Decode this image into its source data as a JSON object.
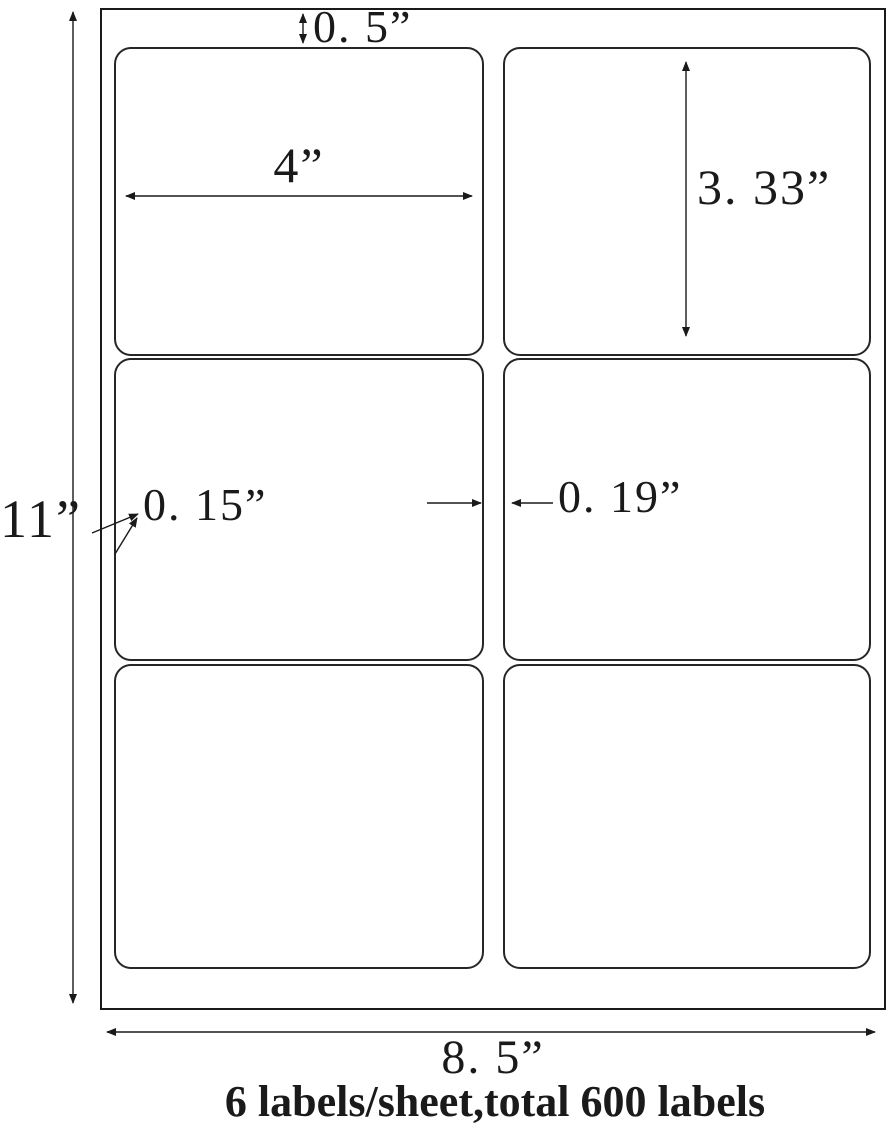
{
  "diagram": {
    "dimensions": {
      "sheet_height": "11”",
      "sheet_width": "8. 5”",
      "top_margin": "0. 5”",
      "label_width": "4”",
      "label_height": "3. 33”",
      "corner_radius": "0. 15”",
      "column_gap": "0. 19”"
    },
    "grid": {
      "rows": 3,
      "columns": 2
    },
    "caption": "6 labels/sheet,total 600 labels"
  },
  "colors": {
    "ink": "#1a1a1a",
    "paper": "#ffffff"
  }
}
